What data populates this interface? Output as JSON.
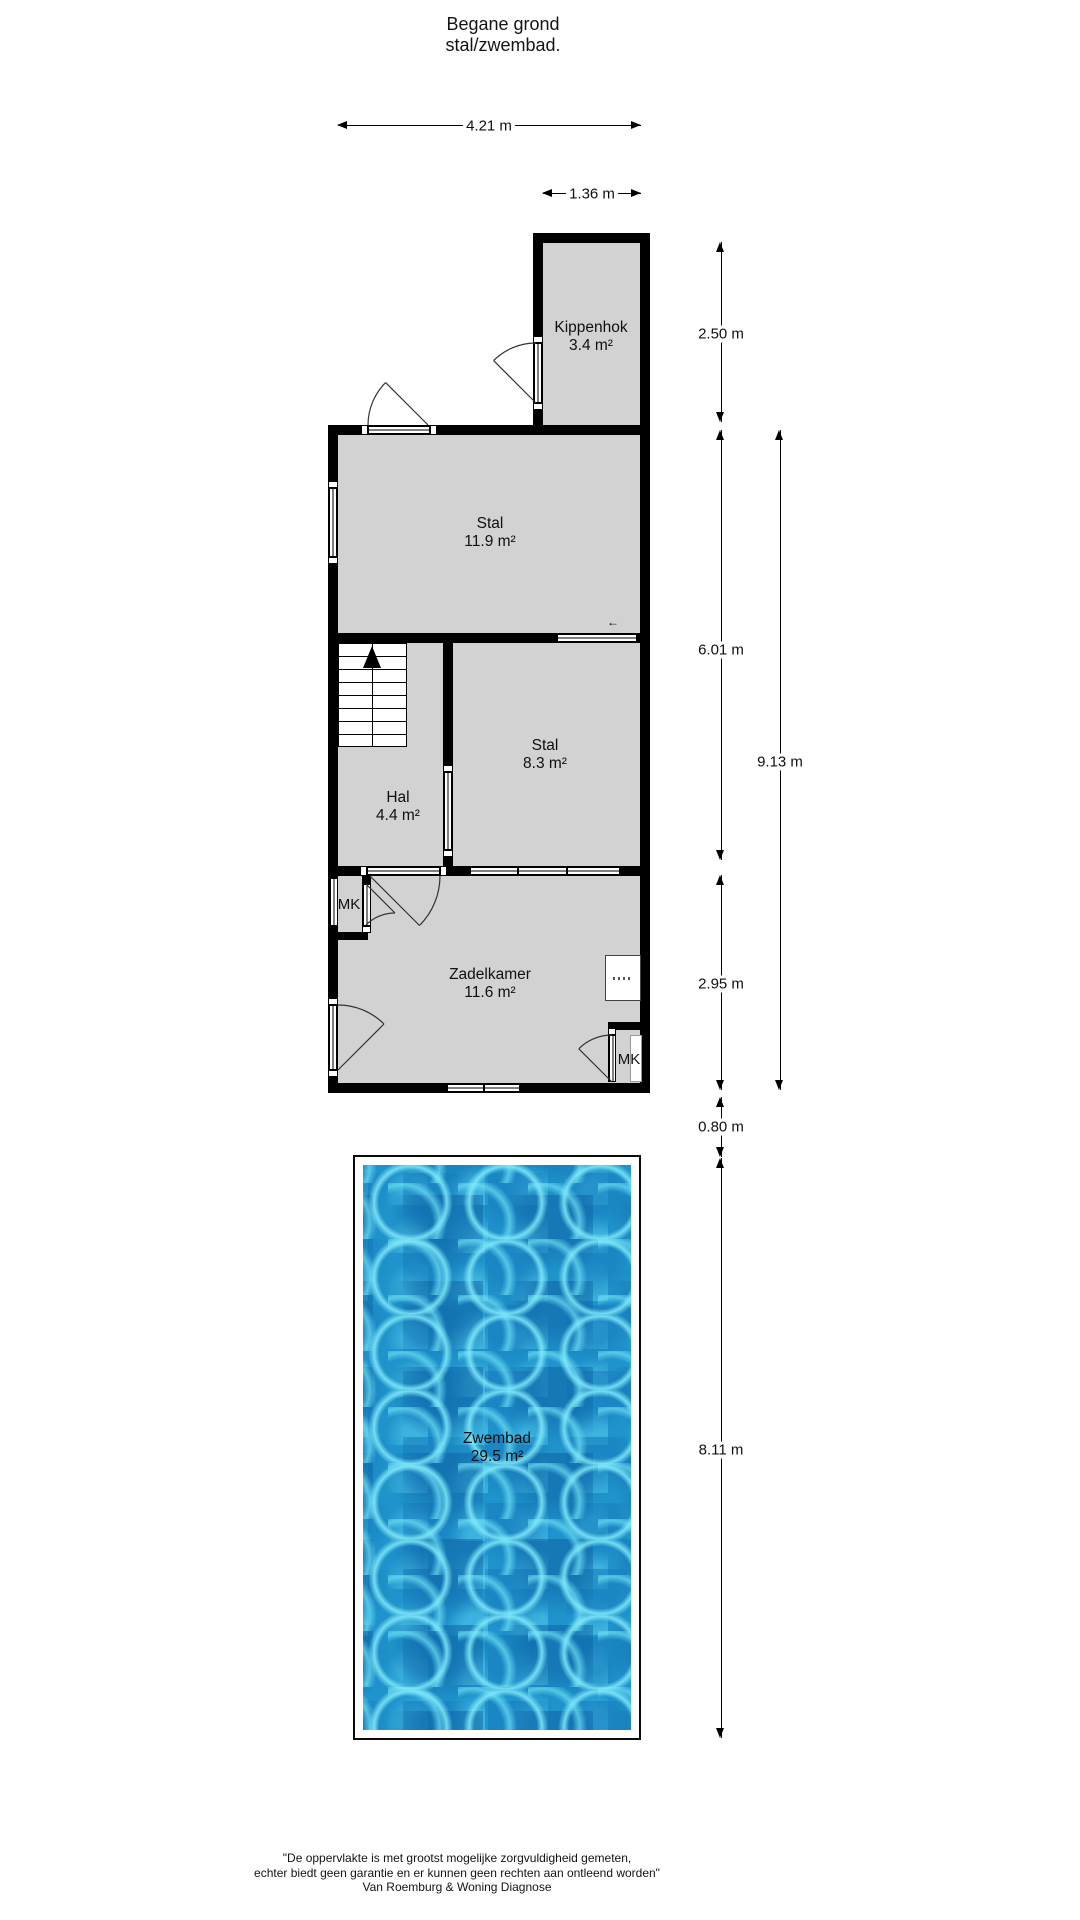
{
  "title": {
    "line1": "Begane grond",
    "line2": "stal/zwembad."
  },
  "dimensions": {
    "top": [
      {
        "label": "4.21 m"
      },
      {
        "label": "1.36 m"
      }
    ],
    "right": [
      {
        "label": "2.50 m"
      },
      {
        "label": "6.01 m"
      },
      {
        "label": "9.13 m"
      },
      {
        "label": "2.95 m"
      },
      {
        "label": "0.80 m"
      },
      {
        "label": "8.11 m"
      }
    ]
  },
  "rooms": [
    {
      "name": "Kippenhok",
      "area": "3.4 m²"
    },
    {
      "name": "Stal",
      "area": "11.9 m²"
    },
    {
      "name": "Stal",
      "area": "8.3 m²"
    },
    {
      "name": "Hal",
      "area": "4.4 m²"
    },
    {
      "name": "Zadelkamer",
      "area": "11.6 m²"
    },
    {
      "name": "Zwembad",
      "area": "29.5 m²"
    }
  ],
  "closets": {
    "mk_top": "MK",
    "mk_bottom": "MK"
  },
  "symbols": {
    "small_arrow": "←"
  },
  "footer": {
    "line1": "\"De oppervlakte is met grootst mogelijke zorgvuldigheid gemeten,",
    "line2": "echter biedt geen garantie en er kunnen geen rechten aan ontleend worden\"",
    "line3": "Van Roemburg & Woning Diagnose"
  },
  "colors": {
    "wall": "#000000",
    "room_fill": "#d2d2d2",
    "water_base": "#1f93cb",
    "water_light": "#7de4f4"
  }
}
